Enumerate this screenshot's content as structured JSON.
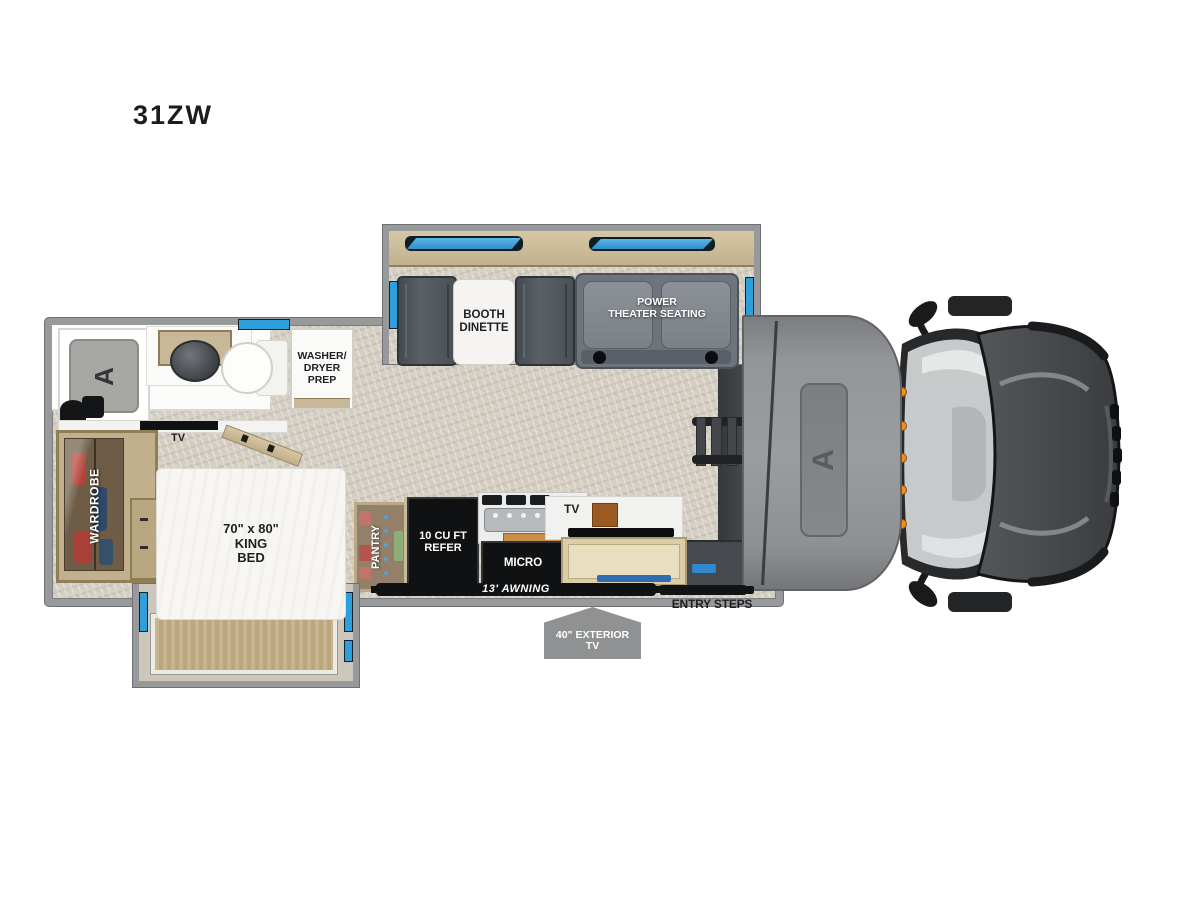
{
  "model": "31ZW",
  "slideout_top": {
    "booth_dinette_label": "BOOTH\nDINETTE",
    "theater_label": "POWER\nTHEATER SEATING"
  },
  "bathroom": {
    "washer_dryer_label": "WASHER/\nDRYER\nPREP"
  },
  "bedroom": {
    "tv_label": "TV",
    "wardrobe_label": "WARDROBE",
    "bed_label": "70\" x 80\"\nKING\nBED"
  },
  "kitchen": {
    "pantry_label": "PANTRY",
    "refrigerator_label": "10 CU FT\nREFER",
    "microwave_label": "MICRO",
    "tv_label": "TV"
  },
  "exterior": {
    "awning_label": "13' AWNING",
    "entry_steps_label": "ENTRY STEPS",
    "exterior_tv_label": "40\" EXTERIOR\nTV"
  },
  "colors": {
    "window_blue": "#2e9fdb",
    "wood": "#c9b897",
    "floor": "#d7d0c5",
    "wall_gray": "#97999b",
    "appliance_black": "#101112",
    "badge_gray": "#8f9193",
    "cap_gray": "#8e9093",
    "accent_orange": "#ef8d1e"
  }
}
